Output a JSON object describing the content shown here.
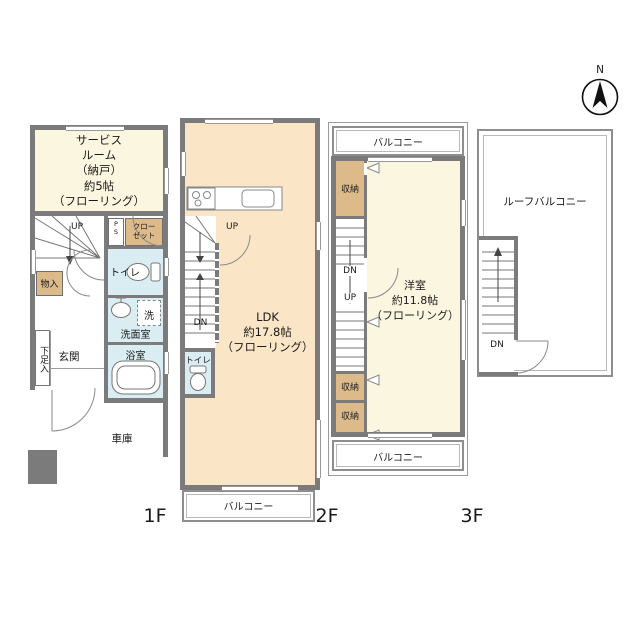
{
  "compass": {
    "north": "N"
  },
  "floor1": {
    "floor_label": "1F",
    "service_room_lines": [
      "サービス",
      "ルーム",
      "（納戸）",
      "約5帖",
      "（フローリング）"
    ],
    "up": "UP",
    "storage": "物入",
    "ps_lines": [
      "P",
      "S"
    ],
    "closet_lines": [
      "クロー",
      "ゼット"
    ],
    "toilet": "トイレ",
    "washer": "洗",
    "washroom": "洗面室",
    "bathroom": "浴室",
    "shoe_storage": "下足入",
    "entrance": "玄関",
    "garage": "車庫"
  },
  "floor2": {
    "floor_label": "2F",
    "up": "UP",
    "down": "DN",
    "toilet": "トイレ",
    "ldk_lines": [
      "LDK",
      "約17.8帖",
      "（フローリング）"
    ],
    "balcony": "バルコニー"
  },
  "floor3": {
    "floor_label": "3F",
    "balcony_top": "バルコニー",
    "balcony_bottom": "バルコニー",
    "storage_top": "収納",
    "storage_mid": "収納",
    "storage_bottom": "収納",
    "down": "DN",
    "up": "UP",
    "room_lines": [
      "洋室",
      "約11.8帖",
      "（フローリング）"
    ]
  },
  "roof": {
    "label": "ルーフバルコニー",
    "down": "DN"
  },
  "colors": {
    "wall": "#7b7b7b",
    "cream": "#faf6df",
    "peach": "#fae6c6",
    "tan": "#dcba8a",
    "wet": "#d9edf3"
  }
}
